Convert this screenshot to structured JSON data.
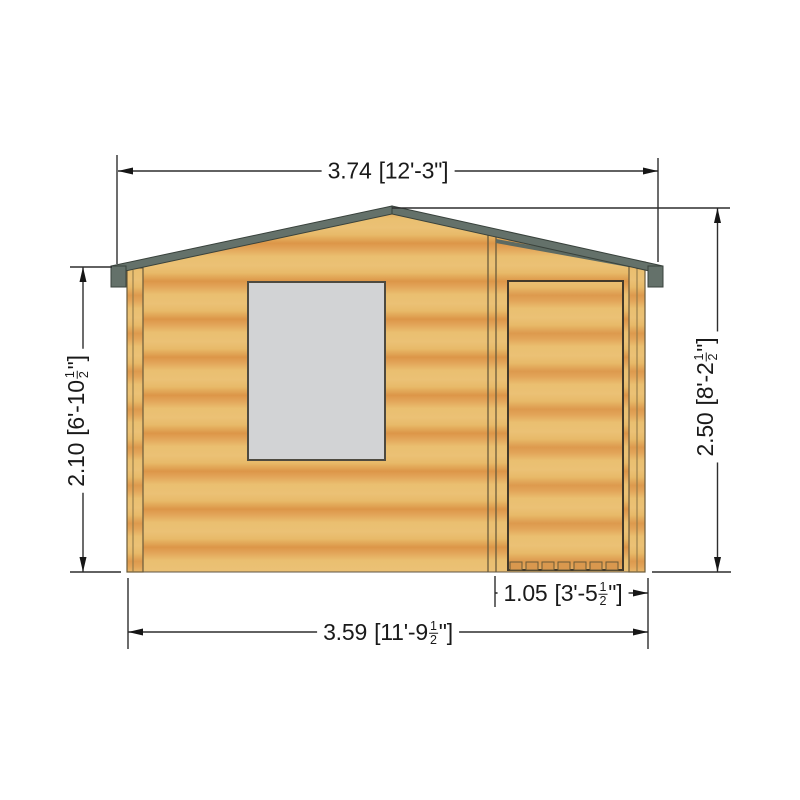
{
  "shed": {
    "wood_base_color": "#ebc175",
    "wood_band_color": "#dc9648",
    "roof_trim_color": "#64716a",
    "roof_trim_edge": "#39423c",
    "window_color": "#d2d3d5",
    "line_color": "#2e2e2e"
  },
  "dimensions": {
    "roof_width": {
      "metric": "3.74",
      "imp_pre": "[12'-3\"]",
      "frac_num": "",
      "frac_den": "",
      "imp_post": ""
    },
    "wall_height": {
      "metric": "2.10",
      "imp_pre": "[6'-10",
      "frac_num": "1",
      "frac_den": "2",
      "imp_post": "\"]"
    },
    "ridge_height": {
      "metric": "2.50",
      "imp_pre": "[8'-2",
      "frac_num": "1",
      "frac_den": "2",
      "imp_post": "\"]"
    },
    "base_width": {
      "metric": "3.59",
      "imp_pre": "[11'-9",
      "frac_num": "1",
      "frac_den": "2",
      "imp_post": "\"]"
    },
    "door_width": {
      "metric": "1.05",
      "imp_pre": "[3'-5",
      "frac_num": "1",
      "frac_den": "2",
      "imp_post": "\"]"
    }
  }
}
